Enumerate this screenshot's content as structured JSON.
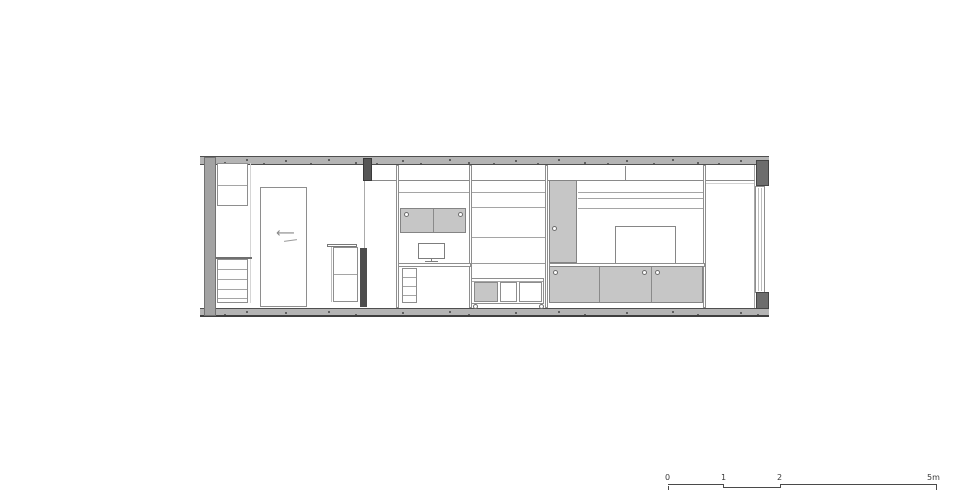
{
  "page": {
    "background": "#ffffff"
  },
  "colors": {
    "slab": "#b4b4b4",
    "slab_edge": "#4f4f4f",
    "wall": "#a3a3a3",
    "cabinet_fill": "#c6c6c6",
    "outline": "#8e8e8e",
    "dark_post": "#4d4d4d",
    "scalebar": "#4a4a4a"
  },
  "scalebar": {
    "label_0": "0",
    "label_1": "1",
    "label_2": "2",
    "label_end": "5m"
  },
  "drawing": {
    "shapes": [
      {
        "n": "ceiling-slab",
        "t": "slab",
        "x": 200,
        "y": 156,
        "w": 569,
        "h": 9
      },
      {
        "n": "floor-slab",
        "t": "slab",
        "cls": "slab-floor",
        "x": 200,
        "y": 308,
        "w": 569,
        "h": 9
      },
      {
        "n": "left-wall",
        "t": "fill",
        "x": 204,
        "y": 157,
        "w": 12,
        "h": 159,
        "bg": "#a3a3a3",
        "br": "1px solid #727272"
      },
      {
        "n": "window-frame-line",
        "t": "vline",
        "x": 754,
        "y": 165,
        "h": 143,
        "bg": "#a8a8a8"
      },
      {
        "n": "window-glazing",
        "t": "rect",
        "x": 755,
        "y": 186,
        "w": 10,
        "h": 107
      },
      {
        "n": "window-glazing-line-1",
        "t": "vline",
        "x": 758,
        "y": 188,
        "h": 103,
        "bg": "#bdbdbd"
      },
      {
        "n": "window-glazing-line-2",
        "t": "vline",
        "x": 761,
        "y": 188,
        "h": 103,
        "bg": "#bdbdbd"
      },
      {
        "n": "window-head-block",
        "t": "fill",
        "x": 756,
        "y": 160,
        "w": 13,
        "h": 26,
        "bg": "#6d6d6d",
        "br": "1px solid #454545"
      },
      {
        "n": "window-sill-block",
        "t": "fill",
        "x": 756,
        "y": 292,
        "w": 13,
        "h": 17,
        "bg": "#6d6d6d",
        "br": "1px solid #454545"
      },
      {
        "n": "shelf-line-top",
        "t": "hline",
        "x": 371,
        "y": 180,
        "w": 384,
        "bg": "#8a8a8a"
      },
      {
        "n": "shelf-line-left-upper",
        "t": "hline",
        "x": 398,
        "y": 192,
        "w": 147,
        "bg": "#a5a5a5"
      },
      {
        "n": "shelf-line-tv-1",
        "t": "hline",
        "x": 578,
        "y": 192,
        "w": 127,
        "bg": "#a5a5a5"
      },
      {
        "n": "shelf-line-tv-2",
        "t": "hline",
        "x": 578,
        "y": 198,
        "w": 127,
        "bg": "#a5a5a5"
      },
      {
        "n": "shelf-line-mid-1",
        "t": "hline",
        "x": 471,
        "y": 207,
        "w": 74,
        "bg": "#a5a5a5"
      },
      {
        "n": "shelf-line-tv-3",
        "t": "hline",
        "x": 578,
        "y": 208,
        "w": 127,
        "bg": "#a5a5a5"
      },
      {
        "n": "shelf-line-mid-2",
        "t": "hline",
        "x": 471,
        "y": 237,
        "w": 74,
        "bg": "#a5a5a5"
      },
      {
        "n": "shelf-line-mid-3",
        "t": "hline",
        "x": 471,
        "y": 263,
        "w": 74,
        "bg": "#9a9a9a"
      },
      {
        "n": "shelf-line-right",
        "t": "hline",
        "x": 706,
        "y": 183,
        "w": 48,
        "bg": "#d2d2d2"
      },
      {
        "n": "cubby-divider",
        "t": "vline",
        "x": 625,
        "y": 166,
        "h": 14,
        "bg": "#8a8a8a"
      },
      {
        "n": "shelf-panel-1",
        "t": "rect",
        "x": 396,
        "y": 165,
        "w": 3,
        "h": 143
      },
      {
        "n": "shelf-panel-2",
        "t": "rect",
        "x": 469,
        "y": 165,
        "w": 3,
        "h": 143
      },
      {
        "n": "shelf-panel-3",
        "t": "rect",
        "x": 545,
        "y": 165,
        "w": 3,
        "h": 143
      },
      {
        "n": "shelf-panel-4",
        "t": "rect",
        "x": 703,
        "y": 165,
        "w": 3,
        "h": 143
      },
      {
        "n": "upper-cabinet",
        "t": "rect",
        "x": 217,
        "y": 163,
        "w": 31,
        "h": 43
      },
      {
        "n": "upper-cabinet-shelf",
        "t": "hline",
        "x": 218,
        "y": 185,
        "w": 29,
        "bg": "#a5a5a5"
      },
      {
        "n": "cabinet-side-line",
        "t": "vline",
        "x": 250,
        "y": 163,
        "h": 140,
        "bg": "#d5d5d5"
      },
      {
        "n": "drawer-unit-top",
        "t": "hline",
        "x": 216,
        "y": 257,
        "w": 36,
        "th": 2,
        "bg": "#6f6f6f"
      },
      {
        "n": "drawer-unit",
        "t": "rect",
        "x": 217,
        "y": 259,
        "w": 31,
        "h": 44
      },
      {
        "n": "drawer-line-1",
        "t": "hline",
        "x": 218,
        "y": 269,
        "w": 29,
        "bg": "#a5a5a5"
      },
      {
        "n": "drawer-line-2",
        "t": "hline",
        "x": 218,
        "y": 279,
        "w": 29,
        "bg": "#a5a5a5"
      },
      {
        "n": "drawer-line-3",
        "t": "hline",
        "x": 218,
        "y": 289,
        "w": 29,
        "bg": "#a5a5a5"
      },
      {
        "n": "drawer-line-4",
        "t": "hline",
        "x": 218,
        "y": 298,
        "w": 29,
        "bg": "#a5a5a5"
      },
      {
        "n": "door-panel",
        "t": "rect",
        "x": 260,
        "y": 187,
        "w": 47,
        "h": 120
      },
      {
        "n": "door-swing-arrow",
        "t": "text",
        "x": 276,
        "y": 227,
        "ch": "⟵",
        "fs": 13,
        "color": "#8a8a8a"
      },
      {
        "n": "door-swing-arrow-underline",
        "t": "hline",
        "x": 284,
        "y": 240,
        "w": 13,
        "bg": "#9a9a9a",
        "rot": -8
      },
      {
        "n": "side-table-top",
        "t": "rect",
        "x": 327,
        "y": 244,
        "w": 30,
        "h": 3,
        "br": "1px solid #787878"
      },
      {
        "n": "side-table-leg",
        "t": "vline",
        "x": 331,
        "y": 247,
        "h": 55,
        "bg": "#bdbdbd"
      },
      {
        "n": "side-table-box",
        "t": "rect",
        "x": 333,
        "y": 247,
        "w": 25,
        "h": 55
      },
      {
        "n": "side-table-shelf",
        "t": "hline",
        "x": 334,
        "y": 274,
        "w": 23,
        "bg": "#a5a5a5"
      },
      {
        "n": "door-track-block",
        "t": "fill",
        "x": 363,
        "y": 158,
        "w": 9,
        "h": 23,
        "bg": "#565656",
        "br": "1px solid #393939"
      },
      {
        "n": "partition-line",
        "t": "vline",
        "x": 364,
        "y": 181,
        "h": 67,
        "bg": "#ababab"
      },
      {
        "n": "partition-post",
        "t": "fill",
        "x": 360,
        "y": 248,
        "w": 7,
        "h": 59,
        "bg": "#4d4d4d"
      },
      {
        "n": "wall-cabinet",
        "t": "fill",
        "x": 400,
        "y": 208,
        "w": 66,
        "h": 25,
        "bg": "#c6c6c6",
        "br": "1px solid #848484"
      },
      {
        "n": "wall-cabinet-divider",
        "t": "vline",
        "x": 433,
        "y": 209,
        "h": 23,
        "bg": "#8a8a8a"
      },
      {
        "n": "wall-cabinet-handle-left",
        "t": "circle",
        "x": 404,
        "y": 212,
        "d": 5
      },
      {
        "n": "wall-cabinet-handle-right",
        "t": "circle",
        "x": 458,
        "y": 212,
        "d": 5
      },
      {
        "n": "monitor",
        "t": "rect",
        "x": 418,
        "y": 243,
        "w": 27,
        "h": 16,
        "br": "1px solid #7d7d7d"
      },
      {
        "n": "monitor-stand",
        "t": "vline",
        "x": 431,
        "y": 259,
        "h": 3,
        "bg": "#7d7d7d"
      },
      {
        "n": "monitor-base",
        "t": "hline",
        "x": 425,
        "y": 261,
        "w": 13,
        "bg": "#7d7d7d"
      },
      {
        "n": "desk-surface",
        "t": "rect",
        "x": 398,
        "y": 263,
        "w": 73,
        "h": 4
      },
      {
        "n": "desk-shelf-unit",
        "t": "rect",
        "x": 402,
        "y": 268,
        "w": 15,
        "h": 35
      },
      {
        "n": "desk-shelf-line-1",
        "t": "hline",
        "x": 403,
        "y": 277,
        "w": 13,
        "bg": "#a5a5a5"
      },
      {
        "n": "desk-shelf-line-2",
        "t": "hline",
        "x": 403,
        "y": 286,
        "w": 13,
        "bg": "#a5a5a5"
      },
      {
        "n": "desk-shelf-line-3",
        "t": "hline",
        "x": 403,
        "y": 295,
        "w": 13,
        "bg": "#a5a5a5"
      },
      {
        "n": "cart-body",
        "t": "rect",
        "x": 471,
        "y": 278,
        "w": 73,
        "h": 26
      },
      {
        "n": "cart-top-line",
        "t": "hline",
        "x": 472,
        "y": 281,
        "w": 71,
        "bg": "#a5a5a5"
      },
      {
        "n": "cart-door",
        "t": "fill",
        "x": 474,
        "y": 282,
        "w": 24,
        "h": 20,
        "bg": "#c6c6c6",
        "br": "1px solid #8a8a8a"
      },
      {
        "n": "cart-cubby-1",
        "t": "rect",
        "x": 500,
        "y": 282,
        "w": 17,
        "h": 20
      },
      {
        "n": "cart-cubby-2",
        "t": "rect",
        "x": 519,
        "y": 282,
        "w": 23,
        "h": 20
      },
      {
        "n": "cart-wheel-left",
        "t": "circle",
        "x": 473,
        "y": 304,
        "d": 5
      },
      {
        "n": "cart-wheel-right",
        "t": "circle",
        "x": 539,
        "y": 304,
        "d": 5
      },
      {
        "n": "tall-cabinet-door",
        "t": "fill",
        "x": 549,
        "y": 180,
        "w": 28,
        "h": 83,
        "bg": "#c6c6c6",
        "br": "1px solid #848484"
      },
      {
        "n": "tall-cabinet-door-handle",
        "t": "circle",
        "x": 552,
        "y": 226,
        "d": 5
      },
      {
        "n": "tv-screen",
        "t": "rect",
        "x": 615,
        "y": 226,
        "w": 61,
        "h": 38,
        "br": "1px solid #868686"
      },
      {
        "n": "media-counter",
        "t": "rect",
        "x": 549,
        "y": 263,
        "w": 156,
        "h": 4
      },
      {
        "n": "media-cabinet",
        "t": "fill",
        "x": 549,
        "y": 266,
        "w": 154,
        "h": 37,
        "bg": "#c6c6c6",
        "br": "1px solid #848484"
      },
      {
        "n": "media-cabinet-divider-1",
        "t": "vline",
        "x": 599,
        "y": 267,
        "h": 35,
        "bg": "#8a8a8a"
      },
      {
        "n": "media-cabinet-divider-2",
        "t": "vline",
        "x": 651,
        "y": 267,
        "h": 35,
        "bg": "#8a8a8a"
      },
      {
        "n": "media-cabinet-handle-1",
        "t": "circle",
        "x": 553,
        "y": 270,
        "d": 5
      },
      {
        "n": "media-cabinet-handle-2",
        "t": "circle",
        "x": 642,
        "y": 270,
        "d": 5
      },
      {
        "n": "media-cabinet-handle-3",
        "t": "circle",
        "x": 655,
        "y": 270,
        "d": 5
      },
      {
        "n": "scalebar-seg-1",
        "t": "hline",
        "x": 668,
        "y": 484,
        "w": 56,
        "bg": "#4a4a4a"
      },
      {
        "n": "scalebar-drop-1",
        "t": "vline",
        "x": 723,
        "y": 484,
        "h": 4,
        "bg": "#4a4a4a"
      },
      {
        "n": "scalebar-seg-2",
        "t": "hline",
        "x": 723,
        "y": 487,
        "w": 58,
        "bg": "#4a4a4a"
      },
      {
        "n": "scalebar-drop-2",
        "t": "vline",
        "x": 780,
        "y": 484,
        "h": 4,
        "bg": "#4a4a4a"
      },
      {
        "n": "scalebar-seg-3",
        "t": "hline",
        "x": 780,
        "y": 484,
        "w": 157,
        "bg": "#4a4a4a"
      },
      {
        "n": "scalebar-tick-0",
        "t": "vline",
        "x": 668,
        "y": 486,
        "h": 4,
        "bg": "#4a4a4a"
      },
      {
        "n": "scalebar-tick-end",
        "t": "vline",
        "x": 936,
        "y": 485,
        "h": 5,
        "bg": "#4a4a4a"
      }
    ]
  }
}
